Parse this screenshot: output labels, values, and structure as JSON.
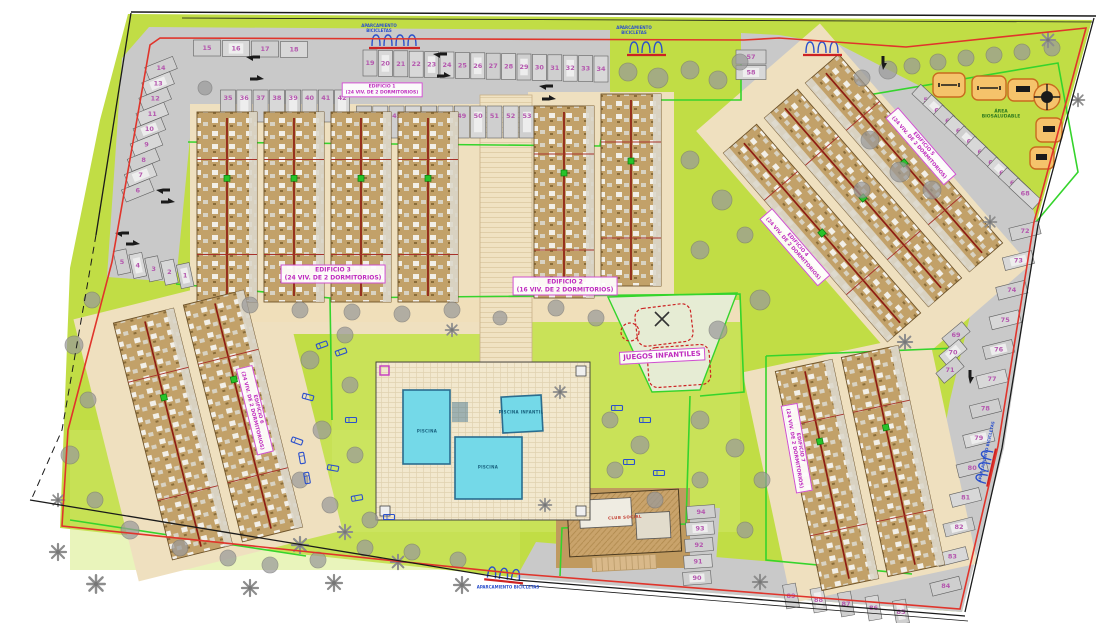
{
  "document": {
    "type": "architectural site plan",
    "language": "es"
  },
  "colors": {
    "garden": "#c1dd45",
    "garden_light": "#cfe668",
    "road": "#c9c9c9",
    "plot_cream": "#efe0bf",
    "deck": "#f2e8ce",
    "pool": "#74d9e8",
    "pool_stroke": "#2a6d8f",
    "building": "#c2a169",
    "boundary_red": "#e0342b",
    "access_dark_red": "#8e1d12",
    "boundary_green": "#35d42c",
    "label_pink": "#bf2cbf",
    "number_pink": "#b457ae",
    "bike_blue": "#2b50cc",
    "gym_orange": "#d9731f",
    "tree_gray": "#9a9a9a"
  },
  "parking": {
    "groups": [
      {
        "id": "row-west-bottom",
        "numbers": [
          5,
          4,
          3,
          2,
          1
        ]
      },
      {
        "id": "col-west",
        "numbers": [
          14,
          13,
          12,
          11,
          10,
          9,
          8,
          7,
          6
        ]
      },
      {
        "id": "row-northwest",
        "numbers": [
          15,
          16,
          17,
          18
        ]
      },
      {
        "id": "row-north-upper",
        "numbers": [
          19,
          20,
          21,
          22,
          23,
          24,
          25,
          26,
          27,
          28,
          29,
          30,
          31,
          32,
          33,
          34
        ]
      },
      {
        "id": "row-north-lower-left",
        "numbers": [
          35,
          36,
          37,
          38,
          39,
          40,
          41,
          42
        ]
      },
      {
        "id": "row-north-lower-right",
        "numbers": [
          43,
          44,
          45,
          46,
          47,
          48,
          49,
          50,
          51,
          52,
          53,
          54,
          55,
          56
        ]
      },
      {
        "id": "pair-entrance",
        "numbers": [
          57,
          58
        ]
      },
      {
        "id": "row-northeast-diagonal",
        "numbers": [
          59,
          60,
          61,
          62,
          63,
          64,
          65,
          66,
          67,
          68
        ]
      },
      {
        "id": "cluster-east",
        "numbers": [
          69,
          70,
          71
        ]
      },
      {
        "id": "col-east",
        "numbers": [
          72,
          73,
          74,
          75,
          76,
          77,
          78,
          79,
          80,
          81,
          82,
          83,
          84
        ]
      },
      {
        "id": "row-south",
        "numbers": [
          89,
          88,
          87,
          86,
          85
        ]
      },
      {
        "id": "col-south-center",
        "numbers": [
          94,
          93,
          92,
          91,
          90
        ]
      }
    ]
  },
  "buildings": [
    {
      "id": "edificio-1",
      "line1": "EDIFICIO 1",
      "line2": "(24 VIV. DE 2 DORMITORIOS)"
    },
    {
      "id": "edificio-2",
      "line1": "EDIFICIO 2",
      "line2": "(16 VIV. DE 2 DORMITORIOS)"
    },
    {
      "id": "edificio-3",
      "line1": "EDIFICIO 3",
      "line2": "(24 VIV. DE 2 DORMITORIOS)"
    },
    {
      "id": "edificio-4",
      "line1": "EDIFICIO 4",
      "line2": "(24 VIV. DE 2 DORMITORIOS)"
    },
    {
      "id": "edificio-5",
      "line1": "EDIFICIO 5",
      "line2": "(24 VIV. DE 2 DORMITORIOS)"
    },
    {
      "id": "edificio-6",
      "line1": "EDIFICIO 6",
      "line2": "(24 VIV. DE 2 DORMITORIOS)"
    },
    {
      "id": "edificio-7",
      "line1": "EDIFICIO 7",
      "line2": "(24 VIV. DE 2 DORMITORIOS)"
    }
  ],
  "labels": {
    "playground": "JUEGOS INFANTILES",
    "fitness_line1": "ÁREA",
    "fitness_line2": "BIOSALUDABLE",
    "bike_line1": "APARCAMIENTO",
    "bike_line2": "BICICLETAS",
    "club": "CLUB SOCIAL",
    "pool_main": "PISCINA",
    "pool_kids": "PISCINA INFANTIL",
    "pool_south": "PISCINA"
  }
}
